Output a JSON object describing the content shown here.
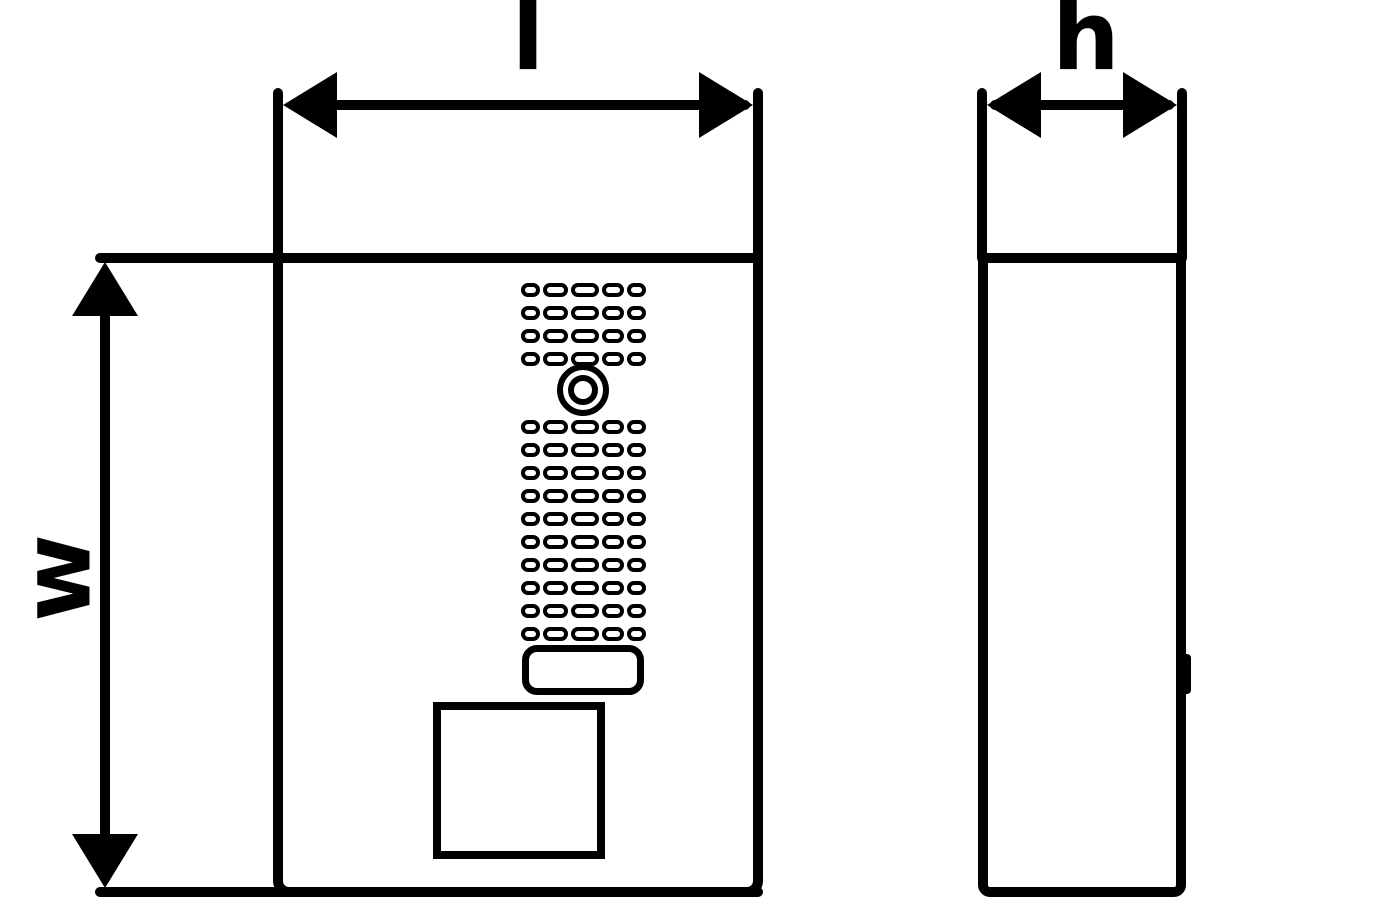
{
  "drawing": {
    "type": "technical-dimension-drawing",
    "views": {
      "front_view_name": "front-view",
      "side_view_name": "side-view"
    }
  },
  "dimensions": {
    "length_label": "l",
    "depth_label": "h",
    "width_label": "w"
  },
  "front_view": {
    "grille": {
      "rows_above_camera": 4,
      "rows_below_camera": 10,
      "slots_per_row": 5,
      "slot_widths": [
        19,
        25,
        28,
        22,
        19
      ],
      "row_pitch": 23,
      "first_row_top": 283,
      "rows_below_start_top": 420
    },
    "features": [
      "speaker-grille",
      "camera-lens",
      "call-button",
      "name-plate"
    ]
  },
  "icons": {
    "arrow_left": "filled-triangle-left",
    "arrow_right": "filled-triangle-right",
    "arrow_up": "filled-triangle-up",
    "arrow_down": "filled-triangle-down"
  },
  "colors": {
    "ink": "#000000",
    "background": "#ffffff"
  }
}
